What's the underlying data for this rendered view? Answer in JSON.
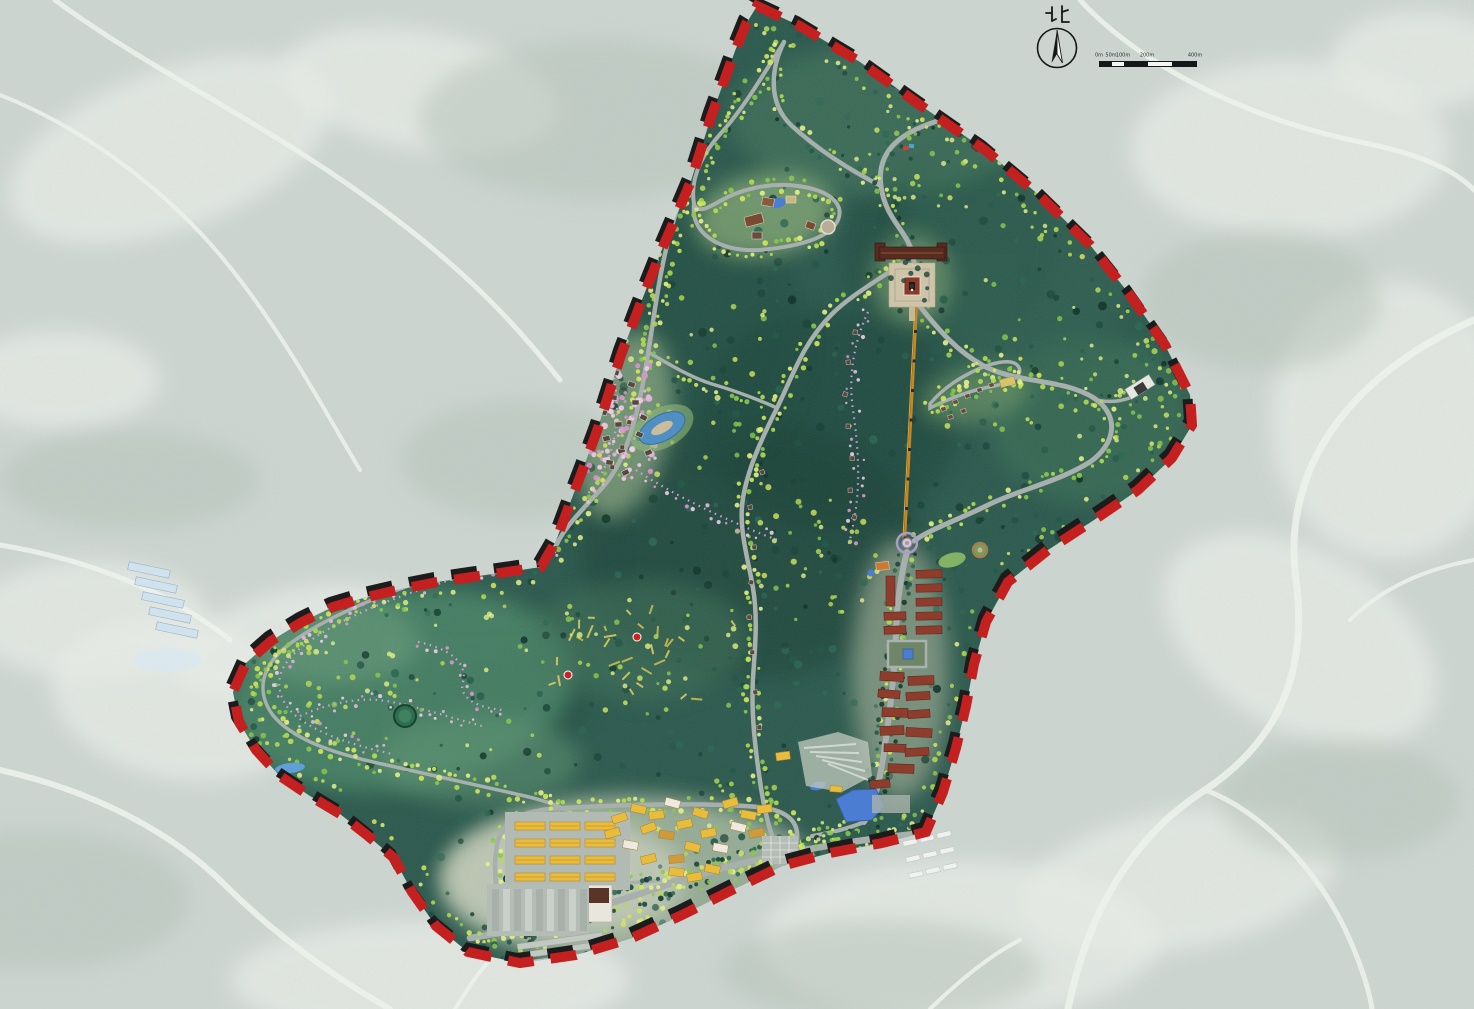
{
  "compass": {
    "north_label": "北"
  },
  "scale_bar": {
    "labels": [
      "0m",
      "50m",
      "100m",
      "200m",
      "400m"
    ]
  },
  "legend_colors": {
    "terrain_outside": "#ccd5d0",
    "terrain_patch_light": "#e9ede8",
    "terrain_patch_grey": "#b7c4bb",
    "outside_road": "#eef2ec",
    "forest_base": "#2a584c",
    "forest_dark": "#1d473c",
    "meadow": "#8fae83",
    "canopy_bright": "#d3e75c",
    "canopy_mid": "#8cc84e",
    "boundary_red": "#c42020",
    "boundary_black": "#1c1c1c",
    "road": "#a7b0ac",
    "road_light": "#b4bcb6",
    "blossom_trail": "#d9a9de",
    "blossom_tree": "#e7b6dd",
    "water": "#4b7ed2",
    "pond_green": "#2e6e50",
    "ropeway": "#c8871e",
    "red_roof": "#8e3c2c",
    "yellow_roof": "#e9bd3b",
    "temple_roof": "#5a2b1f",
    "plaza": "#cdc4aa",
    "house_dark": "#564840",
    "poi_red": "#cc2222",
    "greenhouse_blue": "#cfe2ee"
  },
  "features": [
    {
      "name": "planning-boundary",
      "style": "red-black dashed line"
    },
    {
      "name": "hilltop-temple-complex",
      "style": "dark red gate, plaza, pagoda"
    },
    {
      "name": "hilltop-resort-loop",
      "style": "loop road, pond, buildings"
    },
    {
      "name": "blossom-village",
      "style": "dark roofed houses with pink trees"
    },
    {
      "name": "red-roof-village",
      "style": "rows of red roofed buildings with courtyard"
    },
    {
      "name": "roundabout-plaza",
      "style": "ring circle"
    },
    {
      "name": "ropeway",
      "style": "straight orange line"
    },
    {
      "name": "agritourism-shed-grid",
      "style": "yellow roofed rows"
    },
    {
      "name": "parking-lot",
      "style": "striped bays"
    },
    {
      "name": "visitor-center",
      "style": "white building, brown roof"
    },
    {
      "name": "ponds",
      "style": "blue water bodies"
    },
    {
      "name": "blossom-trails",
      "style": "pink dotted paths"
    }
  ]
}
